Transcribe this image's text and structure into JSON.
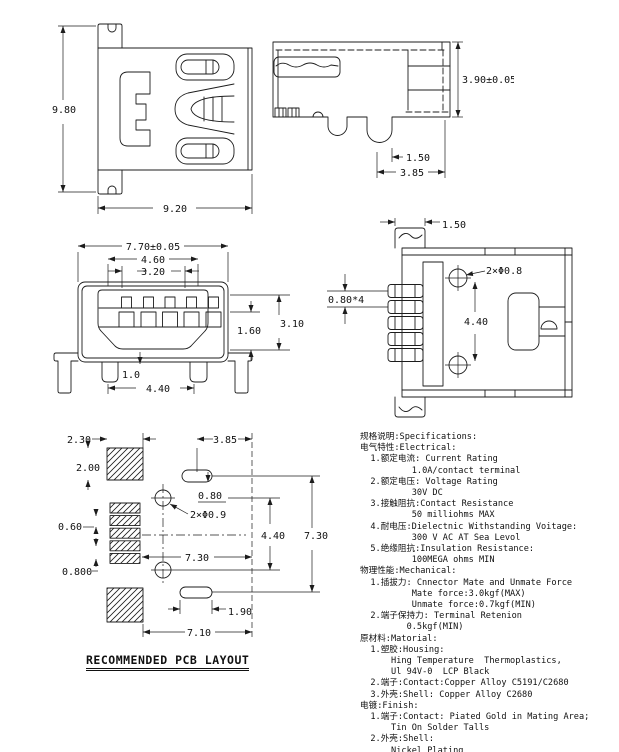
{
  "page": {
    "background": "#ffffff",
    "line_color": "#1c1c1c",
    "text_color": "#111111"
  },
  "views": {
    "top_view": {
      "dim_height": "9.80",
      "dim_width": "9.20"
    },
    "side_view": {
      "dim_height": "3.90±0.05",
      "dim_lead": "1.50",
      "dim_depth": "3.85"
    },
    "front_view": {
      "dim_width": "7.70±0.05",
      "dim_shroud_width": "4.60",
      "dim_slot_width": "3.20",
      "dim_slot_height": "1.60",
      "dim_cavity_height": "3.10",
      "dim_leg_width": "1.0",
      "dim_leg_span": "4.40"
    },
    "bottom_view": {
      "dim_tab": "1.50",
      "dim_holes": "2×Φ0.8",
      "dim_pin_pitch": "0.80*4",
      "dim_hole_span": "4.40"
    },
    "pcb_layout": {
      "title": "RECOMMENDED PCB LAYOUT",
      "dim_pad_width": "2.30",
      "dim_pad_height": "2.00",
      "dim_slot_x": "3.85",
      "dim_slot_drop": "0.80",
      "dim_pad_h": "0.60",
      "dim_holes": "2×Φ0.9",
      "dim_hole_span": "4.40",
      "dim_outer_span": "7.30",
      "dim_inner_span": "7.30",
      "dim_pitch": "0.800",
      "dim_slot_width": "1.90",
      "dim_total_width": "7.10"
    }
  },
  "specs": {
    "lines": [
      "规格说明:Specifications:",
      "电气特性:Electrical:",
      "  1.额定电流: Current Rating",
      "          1.0A/contact terminal",
      "  2.额定电压: Voltage Rating",
      "          30V DC",
      "  3.接触阻抗:Contact Resistance",
      "          50 milliohms MAX",
      "  4.耐电压:Dielectnic Withstanding Voitage:",
      "          300 V AC AT Sea Levol",
      "  5.绝缘阻抗:Insulation Resistance:",
      "          100MEGA ohms MIN",
      "物理性能:Mechanical:",
      "  1.插拔力: Cnnector Mate and Unmate Force",
      "          Mate force:3.0kgf(MAX)",
      "          Unmate force:0.7kgf(MIN)",
      "  2.端子保持力: Terminal Retenion",
      "         0.5kgf(MIN)",
      "原材料:Matorial:",
      "  1.塑胶:Housing:",
      "      Hing Temperature  Thermoplastics,",
      "      Ul 94V-0  LCP Black",
      "  2.端子:Contact:Copper Alloy C5191/C2680",
      "  3.外壳:Shell: Copper Alloy C2680",
      "电镀:Finish:",
      "  1.端子:Contact: Piated Gold in Mating Area;",
      "      Tin On Solder Talls",
      "  2.外壳:Shell:",
      "      Nickel Plating"
    ]
  }
}
